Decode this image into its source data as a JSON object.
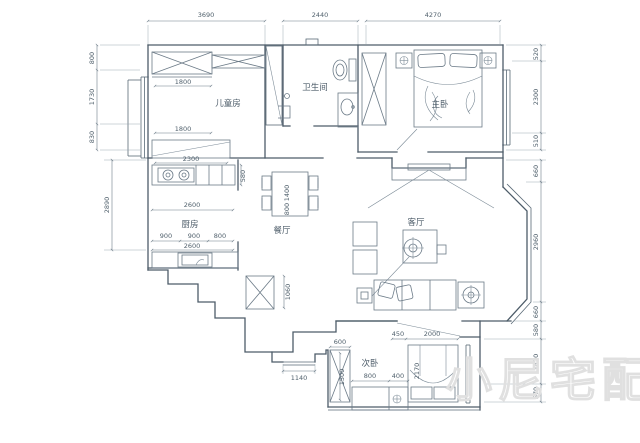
{
  "watermark": "小尼宅配",
  "rooms": {
    "children": "儿童房",
    "bathroom": "卫生间",
    "master": "主卧",
    "kitchen": "厨房",
    "dining": "餐厅",
    "living": "客厅",
    "secondary": "次卧"
  },
  "dims": {
    "top": [
      "3690",
      "2440",
      "4270"
    ],
    "left": [
      "800",
      "1730",
      "830",
      "2890"
    ],
    "right": [
      "520",
      "2300",
      "510",
      "660",
      "2960",
      "660",
      "580",
      "1420",
      "570"
    ],
    "children": [
      "1800",
      "1800"
    ],
    "kitchen": {
      "counter": "2300",
      "depth": "580",
      "width": "2600",
      "splits": [
        "900",
        "900",
        "800"
      ],
      "width2": "2600"
    },
    "dining": {
      "length": "1400",
      "width": "800"
    },
    "entry": {
      "shaft": "1060",
      "door": "1140"
    },
    "secondary": {
      "offset": "450",
      "bed_width": "2000",
      "bed_length": "2170",
      "wardrobe_width": "600",
      "wardrobe_height": "1500",
      "desk": "800",
      "gap": "400"
    }
  }
}
